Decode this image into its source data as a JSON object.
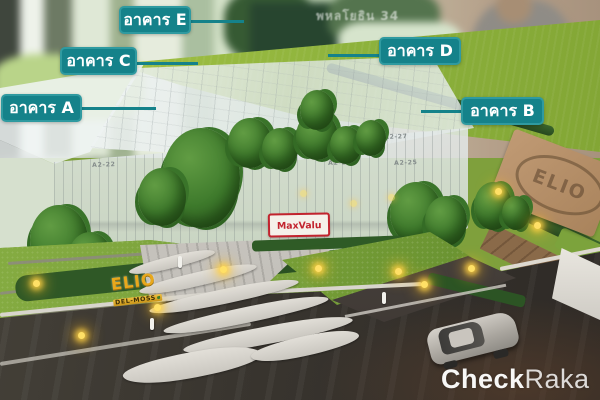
{
  "callouts": {
    "items": [
      {
        "id": "building-a",
        "text": "อาคาร A"
      },
      {
        "id": "building-b",
        "text": "อาคาร B"
      },
      {
        "id": "building-c",
        "text": "อาคาร C"
      },
      {
        "id": "building-d",
        "text": "อาคาร D"
      },
      {
        "id": "building-e",
        "text": "อาคาร E"
      }
    ]
  },
  "signs": {
    "store": "MaxValu",
    "project_title": "ELIO",
    "project_subtitle": "DEL-MOSS",
    "logo_board": "ELIO",
    "window_text": "พหลโยธิน 34"
  },
  "roof_units": {
    "row1": [
      "A2-26",
      "A2-25",
      "A2-27"
    ],
    "row2": [
      "A2-24",
      "A2-25",
      "A2-25"
    ],
    "left": "A2-22"
  },
  "watermark": {
    "bold": "Check",
    "regular": "Raka"
  },
  "colors": {
    "label_teal": "#15828a",
    "label_border": "#2f9aa0",
    "maxvalu_red": "#c2232e",
    "project_gold": "#e8a81c",
    "lawn_green": "#9ebc42",
    "tree_green": "#3e7a2c",
    "road_gray": "#38342f",
    "watermark_white": "#ffffff"
  }
}
